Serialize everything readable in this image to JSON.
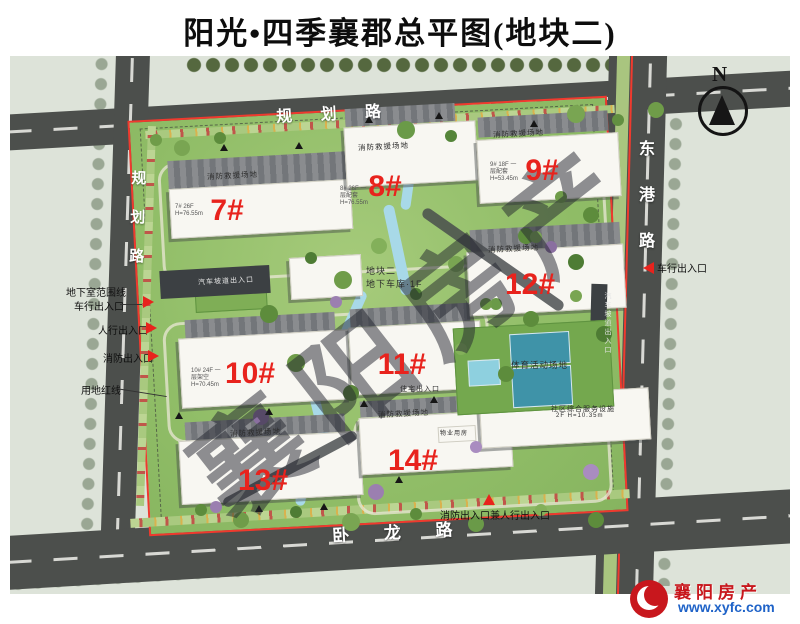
{
  "title": "阳光•四季襄郡总平图(地块二)",
  "compass": {
    "label": "N"
  },
  "roads": {
    "top": "规 划 路",
    "left": "规划路",
    "right": "东港路",
    "bottom": "卧 龙 路"
  },
  "buildings": [
    {
      "label": "7#",
      "caption": "7# 26F H=76.55m"
    },
    {
      "label": "8#",
      "caption": "8# 26F 一层配套 H=76.55m"
    },
    {
      "label": "9#",
      "caption": "9# 18F 一层配套 H=53.45m"
    },
    {
      "label": "10#",
      "caption": "10# 24F 一层架空 H=70.45m"
    },
    {
      "label": "11#",
      "caption": ""
    },
    {
      "label": "12#",
      "caption": ""
    },
    {
      "label": "13#",
      "caption": ""
    },
    {
      "label": "14#",
      "caption": ""
    }
  ],
  "annotations": {
    "basement_line": "地下室范围线",
    "vehicle_entry": "车行出入口",
    "pedestrian_entry": "人行出入口",
    "fire_entry": "消防出入口",
    "land_red_line": "用地红线",
    "fire_pedestrian_entry": "消防出入口兼人行出入口",
    "fire_rescue_area": "消防救援场地",
    "car_ramp_entry": "汽车坡道出入口",
    "parcel_label": "地块二",
    "garage_label": "地下车库·1F",
    "sports_area": "体育活动场地",
    "residential_entry": "住宅出入口",
    "property_room": "物业用房",
    "service_facility": "社区综合服务设施",
    "service_facility_spec": "2F H=10.35m"
  },
  "watermark": {
    "text": "襄阳房产"
  },
  "logo": {
    "name": "襄阳房产",
    "url": "www.xyfc.com"
  },
  "colors": {
    "red_line": "#ef3a2e",
    "building_label": "#e8231d",
    "road": "#4c4f4c",
    "site_green": "#9ec474",
    "water": "#a8d9e8",
    "logo_red": "#c8171d",
    "logo_blue": "#1f63c8"
  }
}
